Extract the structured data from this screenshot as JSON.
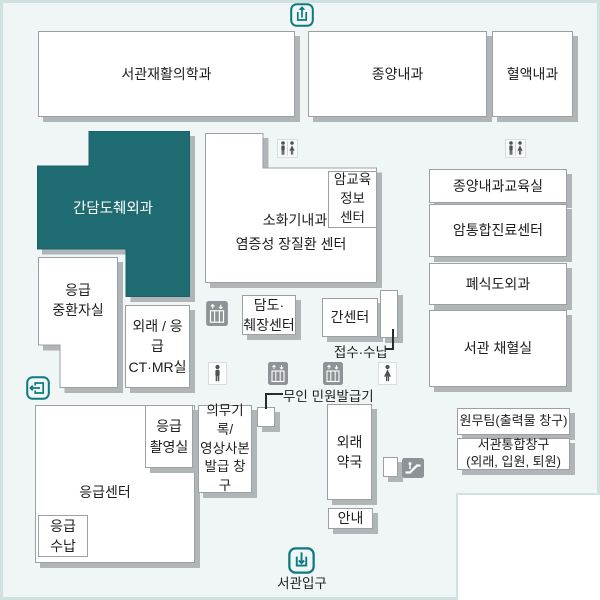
{
  "map_title": "서관입구",
  "colors": {
    "highlight_room_fill": "#1f6b72",
    "background": "#f0f5f5",
    "frame_border": "#cfe2e1",
    "box_border": "#9aa0a4",
    "box_shadow": "#b0b5b7",
    "icon_teal": "#0c7a80",
    "icon_gray": "#8d9397",
    "figure_dark": "#4e5356"
  },
  "rooms": {
    "rehab": {
      "label": "서관재활의학과"
    },
    "oncology": {
      "label": "종양내과"
    },
    "hematology": {
      "label": "혈액내과"
    },
    "hbp_surgery": {
      "label": "간담도췌외과"
    },
    "digestive": {
      "line1": "소화기내과",
      "line2": "염증성 장질환 센터"
    },
    "cancer_edu": {
      "line1": "암교육",
      "line2": "정보",
      "line3": "센터"
    },
    "onco_edu": {
      "label": "종양내과교육실"
    },
    "cancer_center": {
      "label": "암통합진료센터"
    },
    "lung_eso": {
      "label": "폐식도외과"
    },
    "blood_lab": {
      "label": "서관 채혈실"
    },
    "er_icu": {
      "line1": "응급",
      "line2": "중환자실"
    },
    "ct_mr": {
      "line1": "외래 / 응급",
      "line2": "CT·MR실"
    },
    "bile_pancreas": {
      "line1": "담도·",
      "line2": "췌장센터"
    },
    "liver_center": {
      "label": "간센터"
    },
    "er_center": {
      "label": "응급센터"
    },
    "er_xray": {
      "line1": "응급",
      "line2": "촬영실"
    },
    "medical_records": {
      "line1": "의무기록/",
      "line2": "영상사본",
      "line3": "발급 창구"
    },
    "er_pay": {
      "line1": "응급",
      "line2": "수납"
    },
    "pharmacy": {
      "line1": "외래",
      "line2": "약국"
    },
    "info_desk": {
      "label": "안내"
    },
    "admin_team": {
      "label": "원무팀(출력물 창구)"
    },
    "integrated_desk": {
      "line1": "서관통합창구",
      "line2": "(외래, 입원, 퇴원)"
    }
  },
  "labels": {
    "reception": "접수·수납",
    "kiosk": "무인 민원발급기",
    "entrance": "서관입구"
  },
  "icons": {
    "top_entrance": "arrow-up-from-box",
    "side_exit": "arrow-left-through-door",
    "main_entrance": "arrow-down-into-box",
    "restroom_unisex": "male-and-female-figures",
    "restroom_male": "male-figure",
    "restroom_female": "female-figure",
    "elevator": "elevator-cab-with-up-down-arrows",
    "escalator": "person-on-escalator"
  }
}
